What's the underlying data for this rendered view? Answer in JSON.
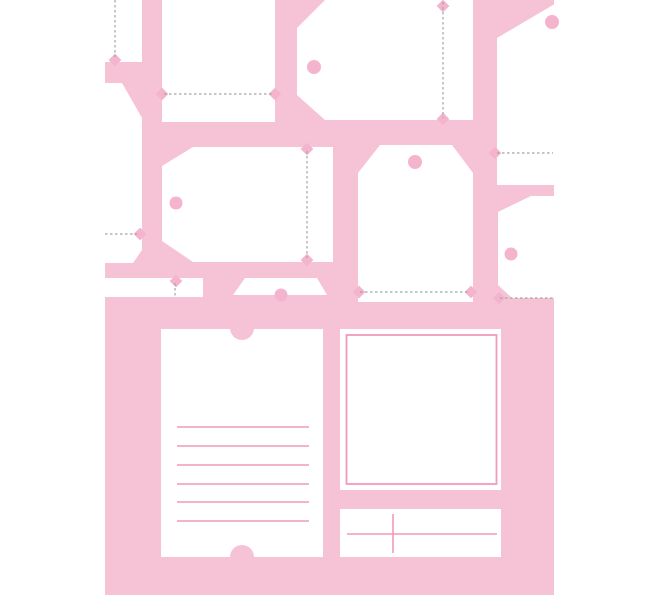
{
  "canvas": {
    "width": 660,
    "height": 600
  },
  "description": "Printable gift tag and label template sheet on pink background",
  "colors": {
    "page_background": "#ffffff",
    "sheet_pink": "#f6c3d6",
    "tag_white": "#ffffff",
    "hole_pink": "#f5b4cd",
    "rule_pink": "#f19ab9",
    "dash_gray": "#a3a3a3"
  },
  "sheet": {
    "x": 105,
    "y": 0,
    "width": 449,
    "height": 595
  },
  "tags": [
    {
      "name": "tag-flap-top-left",
      "points": "0,0 142,0 142,62 0,62"
    },
    {
      "name": "tag-left-edge",
      "points": "0,83 122,83 142,118 142,250 133,263 0,263"
    },
    {
      "name": "tag-rect-top",
      "points": "162,0 275,0 275,122 162,122"
    },
    {
      "name": "tag-large-top",
      "points": "325,0 473,0 473,120 325,120 297,95 297,28"
    },
    {
      "name": "tag-top-right",
      "points": "497,38 553,5 554,5 554,185 497,185"
    },
    {
      "name": "tag-middle-left",
      "points": "193,147 333,147 333,262 193,262 162,241 162,166"
    },
    {
      "name": "tag-middle",
      "points": "380,145 452,145 473,173 473,302 358,302 358,173"
    },
    {
      "name": "tag-middle-right",
      "points": "531,196 554,196 554,298 512,298 498,285 498,212"
    },
    {
      "name": "tag-strip-bottom-left",
      "points": "104,278 203,278 203,297 104,297"
    },
    {
      "name": "tag-trapezoid-bottom",
      "points": "245,278 317,278 327,295 233,295"
    }
  ],
  "holes": [
    {
      "cx": 314,
      "cy": 67,
      "r": 7
    },
    {
      "cx": 552,
      "cy": 22,
      "r": 7
    },
    {
      "cx": 176,
      "cy": 203,
      "r": 6.5
    },
    {
      "cx": 415,
      "cy": 162,
      "r": 7
    },
    {
      "cx": 511,
      "cy": 254,
      "r": 6.5
    },
    {
      "cx": 281,
      "cy": 295,
      "r": 6.5
    }
  ],
  "fold_lines": [
    {
      "x1": 115,
      "y1": 0,
      "x2": 115,
      "y2": 57
    },
    {
      "x1": 164,
      "y1": 94,
      "x2": 273,
      "y2": 94
    },
    {
      "x1": 443,
      "y1": 2,
      "x2": 443,
      "y2": 118
    },
    {
      "x1": 105,
      "y1": 234,
      "x2": 137,
      "y2": 234
    },
    {
      "x1": 307,
      "y1": 151,
      "x2": 307,
      "y2": 258
    },
    {
      "x1": 360,
      "y1": 292,
      "x2": 470,
      "y2": 292
    },
    {
      "x1": 175,
      "y1": 283,
      "x2": 175,
      "y2": 296
    },
    {
      "x1": 497,
      "y1": 153,
      "x2": 553,
      "y2": 153
    },
    {
      "x1": 500,
      "y1": 298,
      "x2": 554,
      "y2": 298
    }
  ],
  "notches": [
    {
      "cx": 115,
      "cy": 60
    },
    {
      "cx": 162,
      "cy": 94
    },
    {
      "cx": 275,
      "cy": 94
    },
    {
      "cx": 443,
      "cy": 6
    },
    {
      "cx": 443,
      "cy": 119
    },
    {
      "cx": 140,
      "cy": 234
    },
    {
      "cx": 307,
      "cy": 149
    },
    {
      "cx": 307,
      "cy": 260
    },
    {
      "cx": 359,
      "cy": 292
    },
    {
      "cx": 471,
      "cy": 292
    },
    {
      "cx": 176,
      "cy": 281
    },
    {
      "cx": 495,
      "cy": 153
    },
    {
      "cx": 499,
      "cy": 298
    }
  ],
  "ticket_card": {
    "x": 161,
    "y": 329,
    "width": 162,
    "height": 228,
    "notch_top": {
      "cx": 242,
      "cy": 328,
      "r": 12
    },
    "notch_bottom": {
      "cx": 242,
      "cy": 557,
      "r": 12
    },
    "lines": {
      "x1": 177,
      "x2": 309,
      "ys": [
        427,
        446,
        465,
        484,
        502,
        521
      ]
    }
  },
  "photo_frame": {
    "x": 340,
    "y": 329,
    "width": 161,
    "height": 161,
    "inner": {
      "x": 346.5,
      "y": 335,
      "width": 150,
      "height": 149
    }
  },
  "cross_card": {
    "x": 340,
    "y": 509,
    "width": 161,
    "height": 48,
    "hline": {
      "x1": 347,
      "y1": 534,
      "x2": 497,
      "y2": 534
    },
    "vline": {
      "x1": 393,
      "y1": 514,
      "x2": 393,
      "y2": 553
    }
  }
}
